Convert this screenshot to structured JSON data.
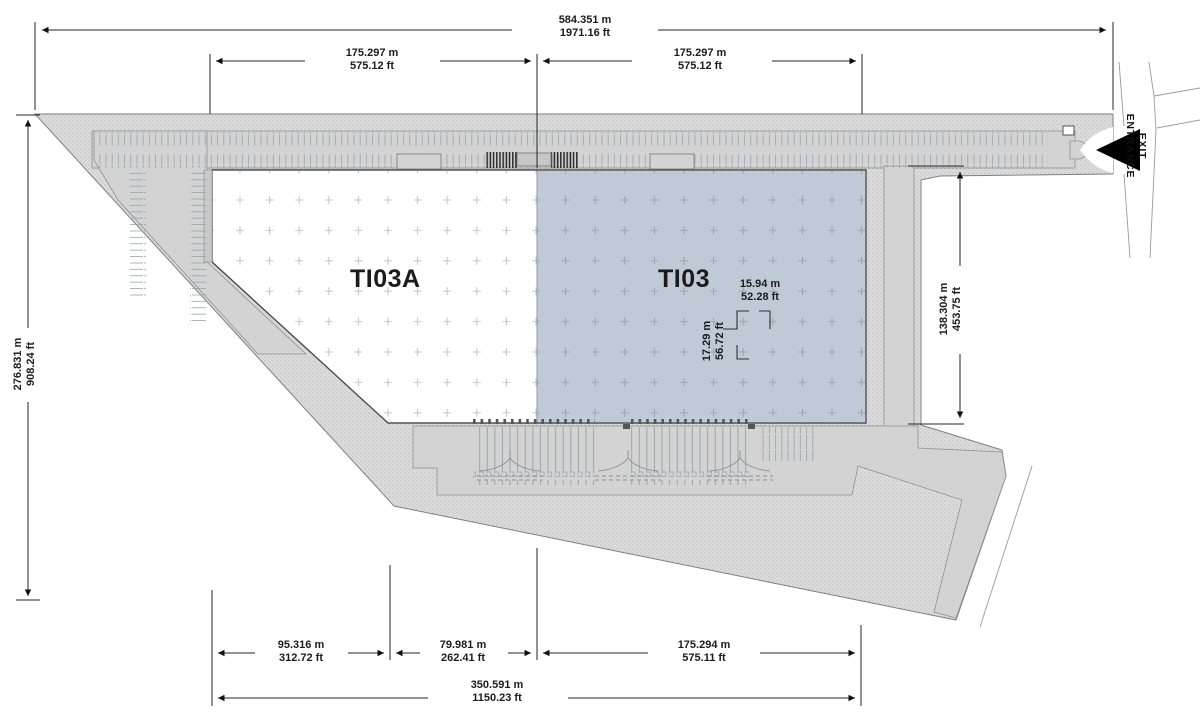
{
  "plan": {
    "units": [
      {
        "id": "TI03A",
        "highlighted": false
      },
      {
        "id": "TI03",
        "highlighted": true
      }
    ],
    "entrance": {
      "line1": "ENTRANCE",
      "line2": "EXIT"
    }
  },
  "dimensions": {
    "top_overall": {
      "m": "584.351 m",
      "ft": "1971.16 ft"
    },
    "top_left_span": {
      "m": "175.297 m",
      "ft": "575.12 ft"
    },
    "top_right_span": {
      "m": "175.297 m",
      "ft": "575.12 ft"
    },
    "left_overall": {
      "m": "276.831 m",
      "ft": "908.24 ft"
    },
    "right_span": {
      "m": "138.304 m",
      "ft": "453.75 ft"
    },
    "bay_width": {
      "m": "15.94 m",
      "ft": "52.28 ft"
    },
    "bay_depth": {
      "m": "17.29 m",
      "ft": "56.72 ft"
    },
    "bottom_left_span": {
      "m": "95.316 m",
      "ft": "312.72 ft"
    },
    "bottom_mid_span": {
      "m": "79.981 m",
      "ft": "262.41 ft"
    },
    "bottom_right_span": {
      "m": "175.294 m",
      "ft": "575.11 ft"
    },
    "bottom_overall": {
      "m": "350.591 m",
      "ft": "1150.23 ft"
    }
  },
  "colors": {
    "highlight_unit": "#c0cad6",
    "site_fill": "#dbdbdb",
    "paving": "#d3d3d3",
    "ink": "#1c1c1c"
  }
}
